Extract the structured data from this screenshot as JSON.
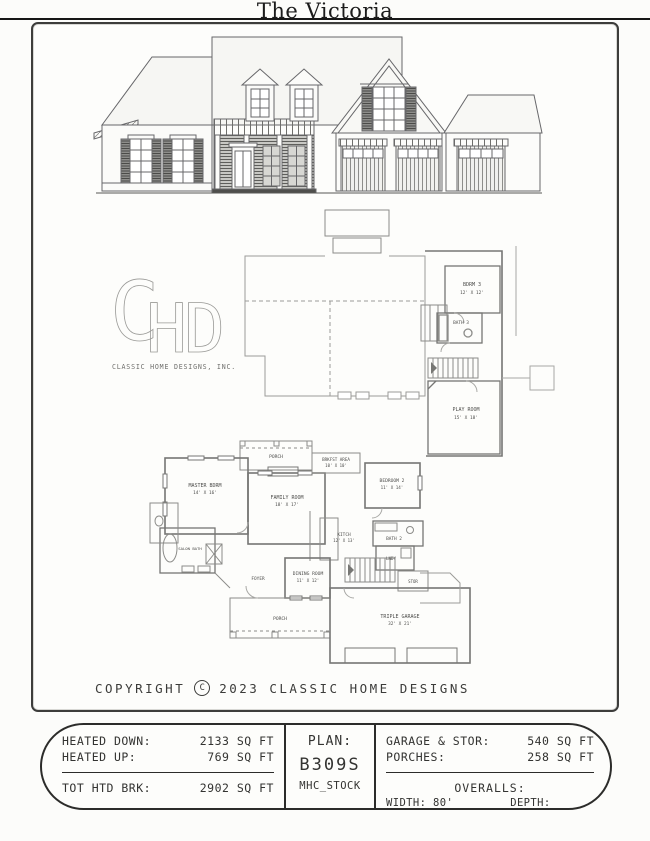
{
  "page": {
    "title": "The Victoria",
    "copyright_pre": "COPYRIGHT",
    "copyright_symbol": "C",
    "copyright_post": "2023 CLASSIC HOME DESIGNS"
  },
  "logo": {
    "letters": {
      "c": "C",
      "h": "H",
      "d": "D"
    },
    "company": "CLASSIC HOME DESIGNS, INC."
  },
  "upper_plan": {
    "bdrm3_name": "BDRM 3",
    "bdrm3_dims": "12' X 12'",
    "bath3_name": "BATH 3",
    "playroom_name": "PLAY ROOM",
    "playroom_dims": "15' X 18'"
  },
  "main_plan": {
    "porch_top": "PORCH",
    "master_name": "MASTER BDRM",
    "master_dims": "14' X 16'",
    "family_name": "FAMILY ROOM",
    "family_dims": "18' X 17'",
    "brkfst_name": "BRKFST AREA",
    "brkfst_dims": "10' X 10'",
    "bedroom2_name": "BEDROOM 2",
    "bedroom2_dims": "11' X 14'",
    "kitch_name": "KITCH",
    "kitch_dims": "12' X 13'",
    "bath2_name": "BATH 2",
    "lndy_name": "LNDY",
    "salon_bath_name": "SALON BATH",
    "dining_name": "DINING ROOM",
    "dining_dims": "11' X 12'",
    "foyer_name": "FOYER",
    "stor_name": "STOR",
    "porch_bottom": "PORCH",
    "garage_name": "TRIPLE GARAGE",
    "garage_dims": "32' X 21'"
  },
  "spec_table": {
    "heated_down_label": "HEATED DOWN:",
    "heated_down_value": "2133 SQ FT",
    "heated_up_label": "HEATED UP:",
    "heated_up_value": "769 SQ FT",
    "tot_htd_label": "TOT HTD BRK:",
    "tot_htd_value": "2902 SQ FT",
    "plan_label": "PLAN:",
    "plan_number": "B309S",
    "plan_series": "MHC_STOCK",
    "garage_stor_label": "GARAGE & STOR:",
    "garage_stor_value": "540 SQ FT",
    "porches_label": "PORCHES:",
    "porches_value": "258 SQ FT",
    "overalls_label": "OVERALLS:",
    "width_value": "WIDTH: 80' -5\"",
    "depth_value": "DEPTH: 63'-4\""
  }
}
